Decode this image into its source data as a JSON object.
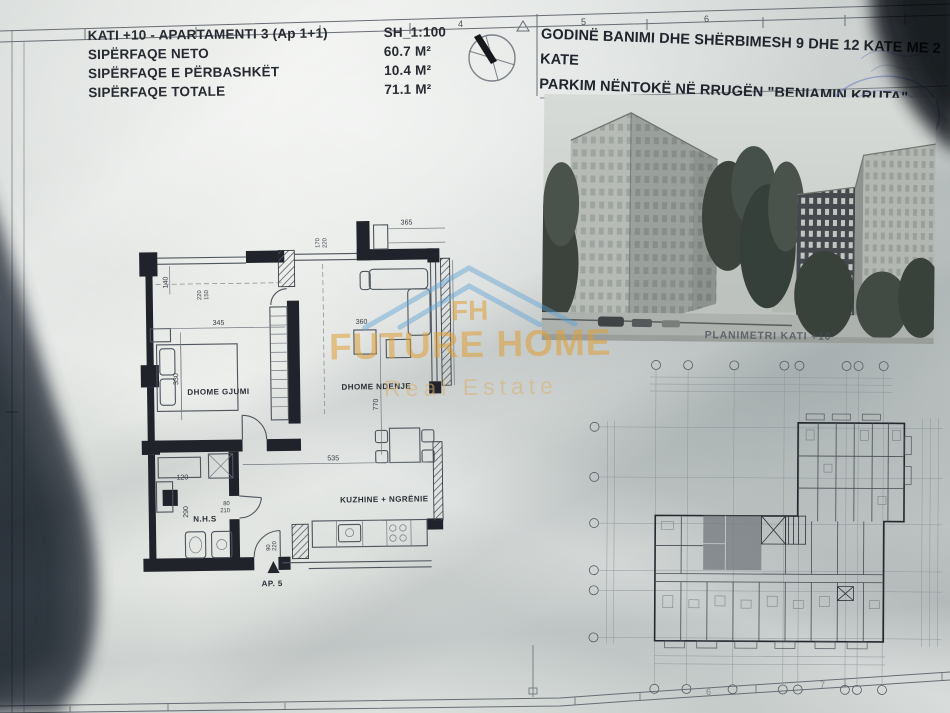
{
  "sheet": {
    "top_ruler": [
      "4",
      "5",
      "6"
    ],
    "bottom_ruler": [
      "6",
      "7"
    ]
  },
  "header": {
    "line1": "KATI +10 - APARTAMENTI 3  (Ap 1+1)",
    "scale": "SH_1:100",
    "rows": [
      {
        "label": "SIPËRFAQE NETO",
        "value": "60.7 M²"
      },
      {
        "label": "SIPËRFAQE E PËRBASHKËT",
        "value": "10.4 M²"
      },
      {
        "label": "SIPËRFAQE TOTALE",
        "value": "71.1 M²"
      }
    ]
  },
  "project_title": {
    "line1": "GODINË BANIMI DHE SHËRBIMESH 9 DHE 12 KATE ME 2 KATE",
    "line2": "PARKIM NËNTOKË NË RRUGËN \"BENIAMIN KRUTA\""
  },
  "rendering": {
    "caption": "PLANIMETRI KATI +10"
  },
  "watermark": {
    "brand": "FUTURE HOME",
    "tagline": "Real Estate",
    "monogram": "FH",
    "orange": "#df9f38",
    "blue": "#5a9fd4"
  },
  "apartment": {
    "rooms": {
      "bedroom": "DHOME GJUMI",
      "living": "DHOME NDENJE",
      "kitchen": "KUZHINE + NGRËNIE",
      "bath": "N.H.S"
    },
    "entrance": "AP. 5",
    "dims": {
      "win_left_a": "140",
      "win_left_b": "220",
      "win_left_c": "150",
      "bedroom_w": "345",
      "bedroom_h": "330",
      "top_window_a": "170",
      "top_window_b": "220",
      "balcony": "365",
      "table": "360",
      "living_h": "770",
      "kitchen_w": "535",
      "bath_w": "120",
      "bath_h": "290",
      "bath_door_a": "80",
      "bath_door_b": "210",
      "entry_door_a": "90",
      "entry_door_b": "220"
    }
  }
}
